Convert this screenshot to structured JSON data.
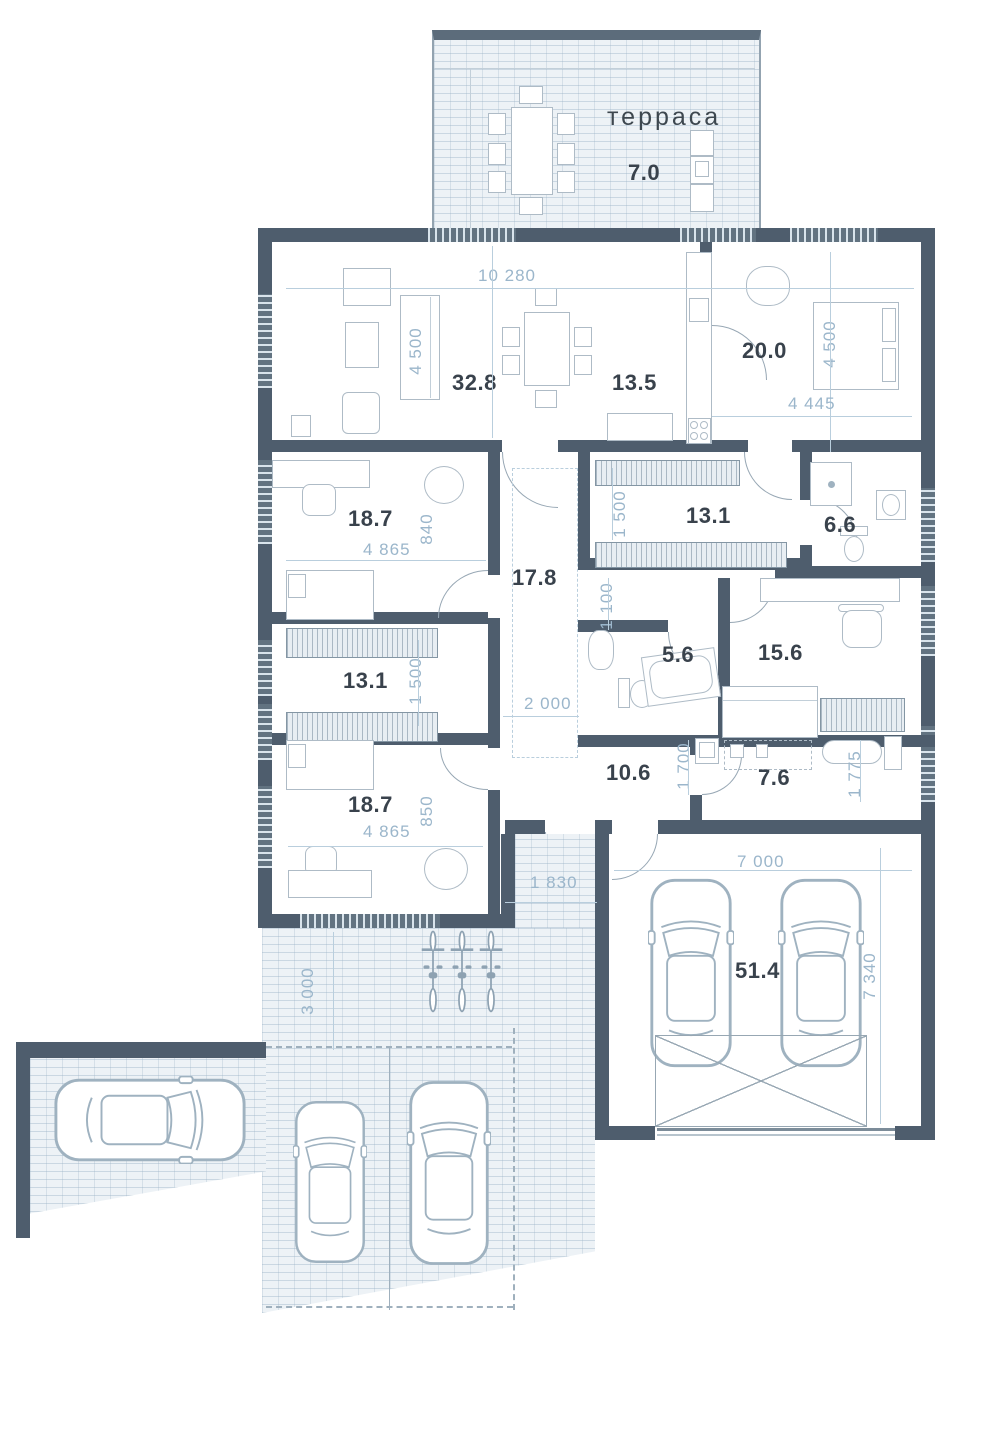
{
  "plan_title": "floor plan",
  "rooms": {
    "terrace": {
      "name": "терраса",
      "area": "7.0"
    },
    "living": {
      "area": "32.8"
    },
    "kitchen": {
      "area": "13.5"
    },
    "bedroom_tr": {
      "area": "20.0"
    },
    "bedroom_tl": {
      "area": "18.7"
    },
    "wardrobe_top": {
      "area": "13.1"
    },
    "bathroom_right": {
      "area": "6.6"
    },
    "hall": {
      "area": "17.8"
    },
    "bathroom_mid": {
      "area": "5.6"
    },
    "study": {
      "area": "15.6"
    },
    "wardrobe_left": {
      "area": "13.1"
    },
    "bedroom_bl": {
      "area": "18.7"
    },
    "corridor": {
      "area": "10.6"
    },
    "laundry": {
      "area": "7.6"
    },
    "garage": {
      "area": "51.4"
    }
  },
  "dims": {
    "living_width": "10 280",
    "living_depth": "4 500",
    "bedroom_depth": "4 500",
    "bedroom_width": "4 445",
    "bedroom_tl_width": "4 865",
    "bedroom_tl_offset": "840",
    "wardrobe_top_depth": "1 500",
    "hall_passage": "1 100",
    "wardrobe_left_depth": "1 500",
    "hall_width": "2 000",
    "corridor_depth": "1 700",
    "laundry_depth": "1 775",
    "bedroom_bl_width": "4 865",
    "bedroom_bl_offset": "850",
    "porch_width": "1 830",
    "garage_width": "7 000",
    "garage_depth": "7 340",
    "walkway_width": "3 000"
  },
  "colors": {
    "wall": "#4e5d6d",
    "dimension_text": "#9bb6cb",
    "room_label": "#39424c",
    "hatch_background": "#edf2f6"
  }
}
